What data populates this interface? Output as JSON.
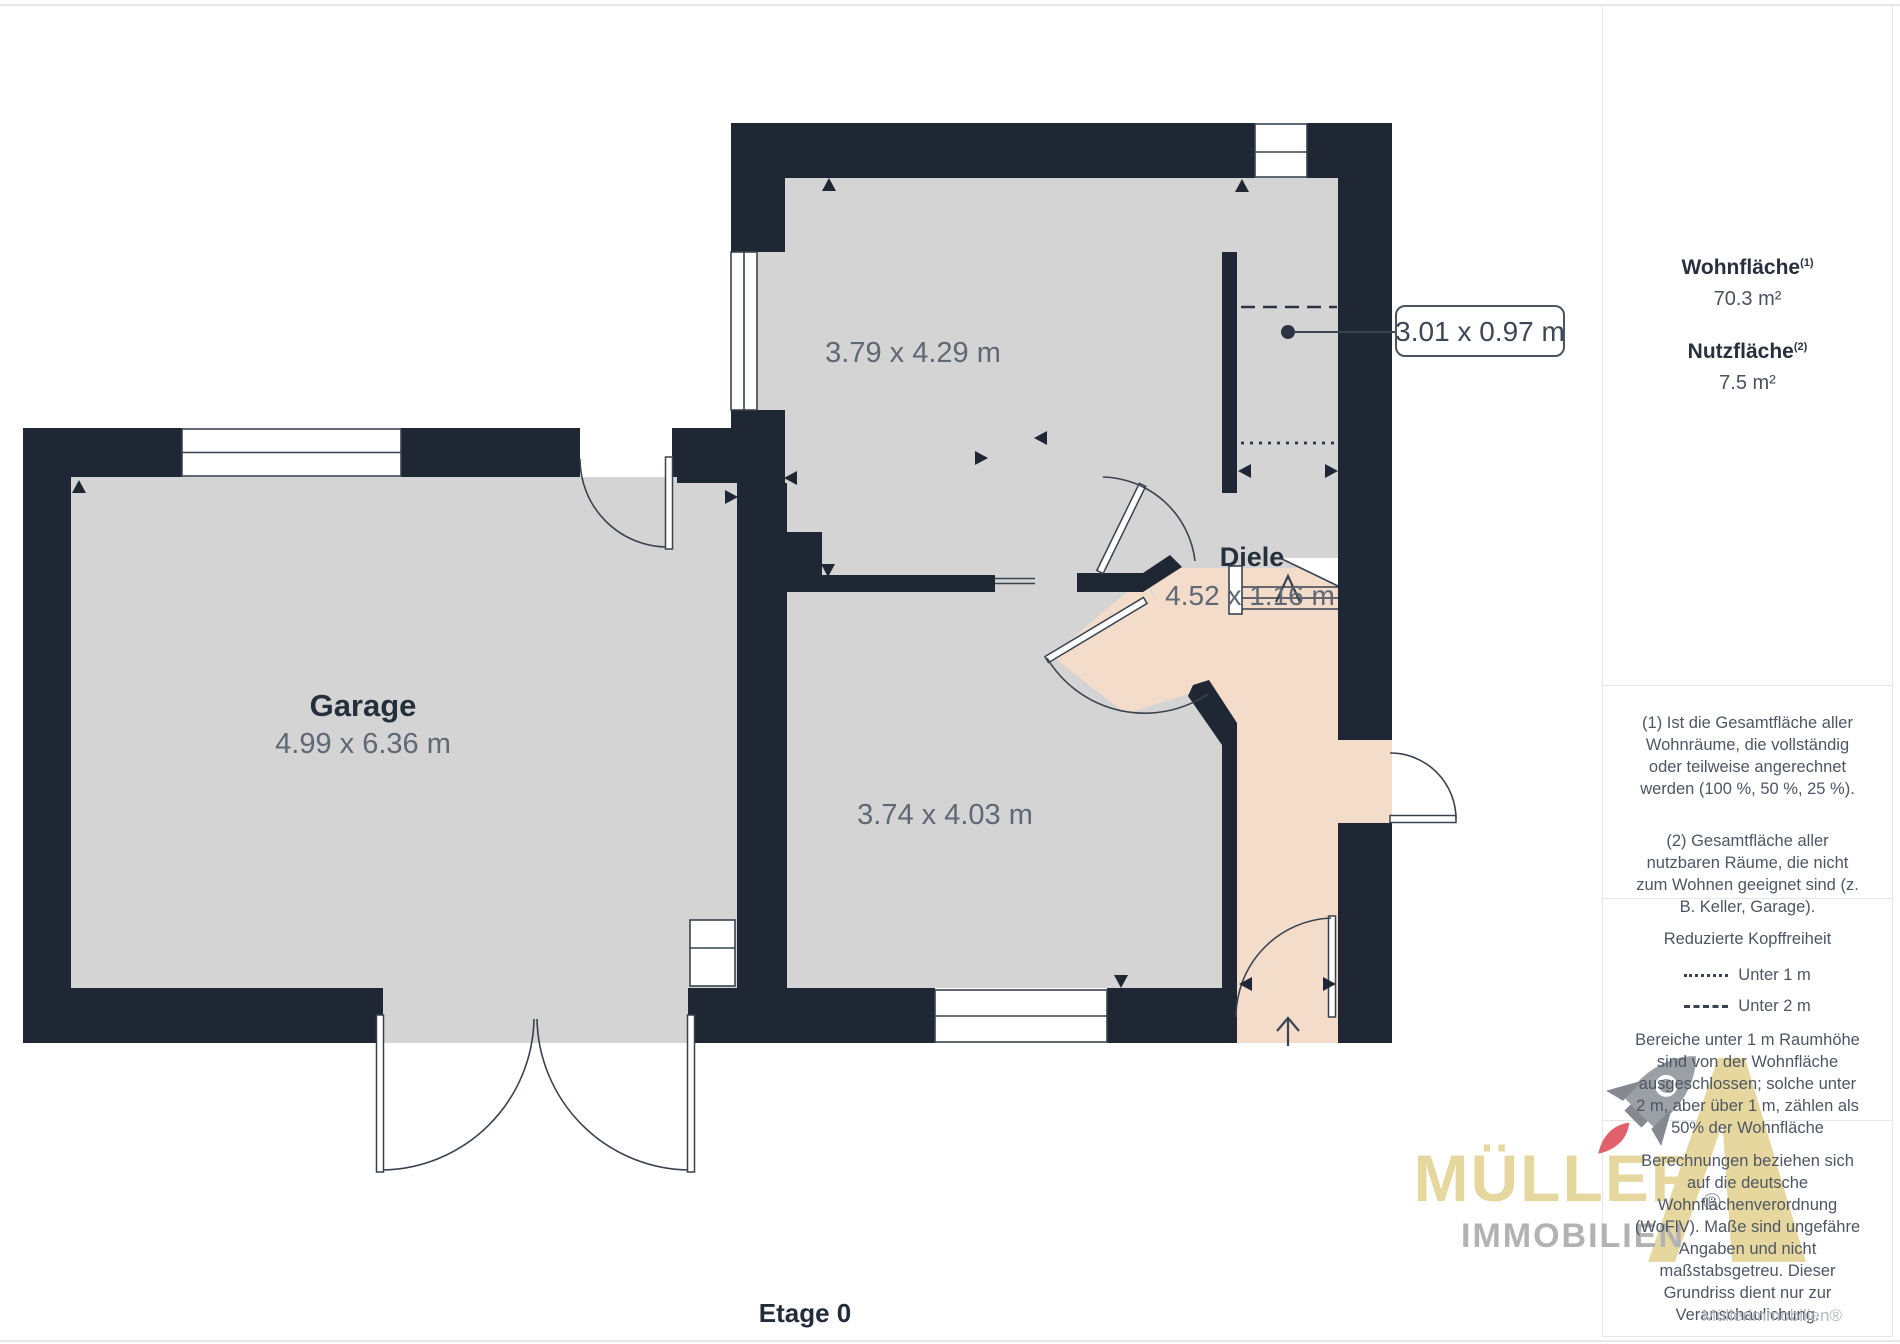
{
  "plan": {
    "floor_label": "Etage 0",
    "callout_dim": "3.01 x 0.97 m",
    "rooms": {
      "garage": {
        "name": "Garage",
        "dims": "4.99 x 6.36 m"
      },
      "room_top": {
        "dims": "3.79 x 4.29 m"
      },
      "room_mid": {
        "dims": "3.74 x 4.03 m"
      },
      "diele": {
        "name": "Diele",
        "dims": "4.52 x 1.16 m"
      }
    },
    "colors": {
      "wall": "#1e2733",
      "floor": "#d4d4d4",
      "diele_floor": "#f3dcca"
    }
  },
  "sidebar": {
    "wohnflaeche": {
      "label": "Wohnfläche",
      "sup": "(1)",
      "value": "70.3 m²"
    },
    "nutzflaeche": {
      "label": "Nutzfläche",
      "sup": "(2)",
      "value": "7.5 m²"
    },
    "note1": "(1) Ist die Gesamtfläche aller Wohnräume, die vollständig oder teilweise angerechnet werden (100 %, 50 %, 25 %).",
    "note2": "(2) Gesamtfläche aller nutzbaren Räume, die nicht zum Wohnen geeignet sind (z. B. Keller, Garage).",
    "legend": {
      "title": "Reduzierte Kopffreiheit",
      "items": [
        {
          "label": "Unter 1 m",
          "style": "dotted"
        },
        {
          "label": "Unter 2 m",
          "style": "dashed"
        }
      ],
      "note": "Bereiche unter 1 m Raumhöhe sind von der Wohnfläche ausgeschlossen; solche unter 2 m, aber über 1 m, zählen als 50% der Wohnfläche"
    },
    "disclaimer": "Berechnungen beziehen sich auf die deutsche Wohnflächenverordnung (WoFlV). Maße sind ungefähre Angaben und nicht maßstabsgetreu. Dieser Grundriss dient nur zur Veranschaulichung.",
    "brand": {
      "name": "GIRAFFE",
      "suffix": "360"
    }
  },
  "watermark": {
    "title": "MÜLLER",
    "subtitle": "IMMOBILIEN",
    "reg": "®",
    "colors": {
      "gold": "#e6d79f",
      "gray": "#9aa0a6",
      "flame": "#e0606c"
    }
  },
  "credit": "Müllerimmobilien®"
}
